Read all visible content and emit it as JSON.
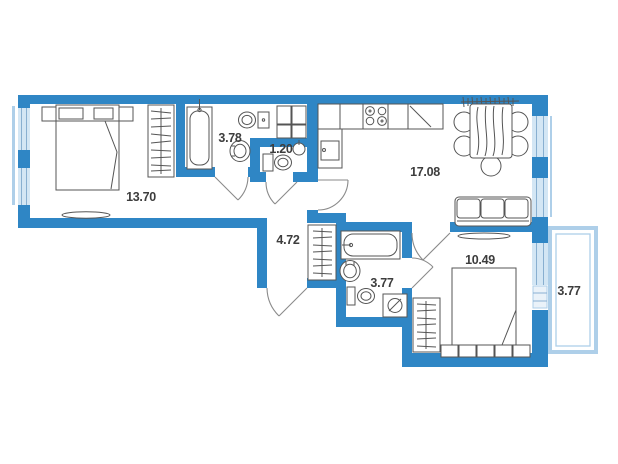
{
  "plan_title": "two-room apartment floor plan",
  "colors": {
    "wall": "#2f86c5",
    "window_fill": "#d3e6f4",
    "window_frame": "#7fa9cd",
    "balcony": "#aecfe9",
    "fixture_line": "#555555",
    "text": "#3d3d3d"
  },
  "rooms": [
    {
      "name": "bedroom-1",
      "area": "13.70"
    },
    {
      "name": "bathroom-1",
      "area": "3.78"
    },
    {
      "name": "wc",
      "area": "1.20"
    },
    {
      "name": "kitchen-living",
      "area": "17.08"
    },
    {
      "name": "hallway",
      "area": "4.72"
    },
    {
      "name": "bathroom-2",
      "area": "3.77"
    },
    {
      "name": "bedroom-2",
      "area": "10.49"
    },
    {
      "name": "balcony",
      "area": "3.77"
    }
  ]
}
